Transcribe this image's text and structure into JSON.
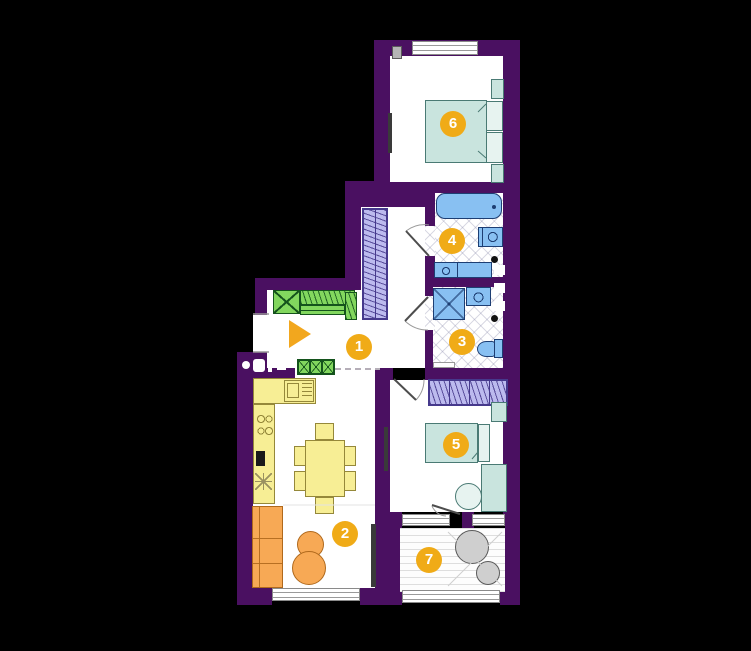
{
  "plan": {
    "type": "apartment-floor-plan",
    "rooms": [
      {
        "number": "1",
        "name": "hallway"
      },
      {
        "number": "2",
        "name": "kitchen-living-room"
      },
      {
        "number": "3",
        "name": "shower-room"
      },
      {
        "number": "4",
        "name": "bathroom"
      },
      {
        "number": "5",
        "name": "bedroom"
      },
      {
        "number": "6",
        "name": "bedroom"
      },
      {
        "number": "7",
        "name": "balcony"
      }
    ]
  },
  "colors": {
    "background": "#000000",
    "wall": "#4a1061",
    "floor": "#ffffff",
    "badge": "#f0ab17",
    "badge-text": "#ffffff",
    "furniture-teal": "#c9e4de",
    "furniture-teal-border": "#4a7a74",
    "fixture-blue": "#88c0f2",
    "fixture-blue-border": "#1d3e73",
    "wardrobe-lavender": "#bcbaee",
    "wardrobe-lavender-border": "#46398c",
    "wardrobe-green": "#82d75e",
    "wardrobe-green-border": "#14531c",
    "kitchen-yellow": "#f7ee95",
    "kitchen-yellow-border": "#95883a",
    "sofa-orange": "#f7a955",
    "sofa-orange-border": "#b0691c",
    "balcony-gray": "#cfcfcf",
    "entry-arrow": "#f2a71e"
  }
}
